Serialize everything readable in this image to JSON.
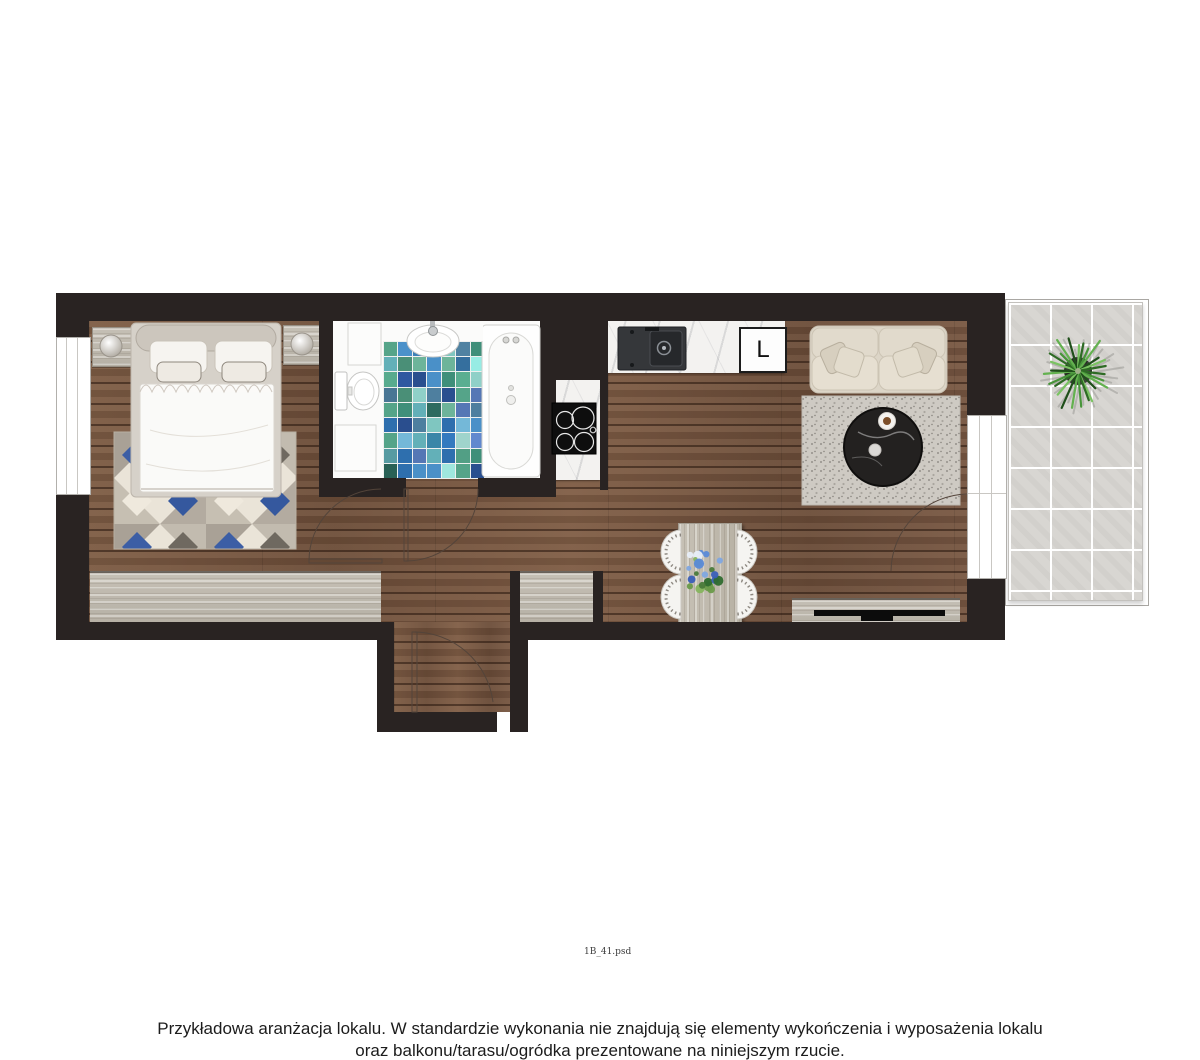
{
  "texts": {
    "disclaimer_line1": "Przykładowa aranżacja lokalu. W standardzie wykonania nie znajdują się elementy wykończenia i wyposażenia lokalu",
    "disclaimer_line2": "oraz balkonu/tarasu/ogródka prezentowane na niniejszym rzucie.",
    "file_label": "1B_41.psd",
    "fridge_label": "L"
  },
  "palette": {
    "wall": "#292322",
    "wood_floor": "#715340",
    "light_wood": "#c7c2b8",
    "marble": "#f3f2f0",
    "rug_blue": "#3c5ea5",
    "balcony_tile": "#d8d6d2",
    "mosaic": [
      "#2e6fae",
      "#4a90c8",
      "#63b0b8",
      "#3f8f7a",
      "#7fc6c0",
      "#2a4f8f",
      "#8fd0c8",
      "#55a489",
      "#356f9e",
      "#74b8d8",
      "#4e7f9f",
      "#9fd4cc",
      "#2d6b5f",
      "#5577b5",
      "#3b86a8",
      "#6db49a"
    ],
    "plant_greens": [
      "#2e6b25",
      "#48953a",
      "#63b14f",
      "#1f4f1a",
      "#7ac362"
    ],
    "bouquet": [
      "#4a7a3a",
      "#6a9a4a",
      "#86b45e",
      "#5a8ad8",
      "#3a5fb8",
      "#7fa6e0",
      "#e8eef8",
      "#2f6b2f"
    ]
  }
}
